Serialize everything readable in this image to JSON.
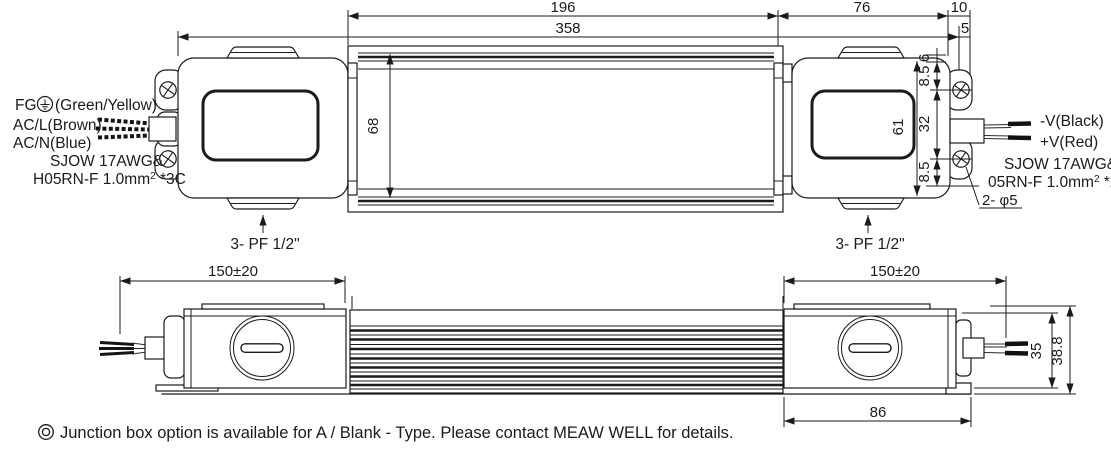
{
  "colors": {
    "ink": "#1b1b1b",
    "paper": "#ffffff"
  },
  "top_view": {
    "dims": {
      "fin_length": "196",
      "overall_length": "358",
      "box_length": "76",
      "bracket_ext": "10",
      "bracket_ext_small": "5",
      "body_width": "68",
      "box_width": "61",
      "hole_pitch": "32",
      "hole_edge_upper": "8.5",
      "edge_small": "6",
      "hole_edge_lower": "8.5"
    },
    "mounting_hole_note": "2- φ5",
    "conduit_note_left": "3- PF 1/2\"",
    "conduit_note_right": "3- PF 1/2\"",
    "input": {
      "fg": "FG",
      "fg_colors": "(Green/Yellow)",
      "line": "AC/L(Brown)",
      "neutral": "AC/N(Blue)",
      "cable1": "SJOW 17AWG&",
      "cable2": "H05RN-F 1.0mm",
      "cable2_sup": "2",
      "cable2_tail": " *3C"
    },
    "output": {
      "v_neg": "-V(Black)",
      "v_pos": "+V(Red)",
      "cable1": "SJOW 17AWG&",
      "cable2": "05RN-F 1.0mm",
      "cable2_sup": "2",
      "cable2_tail": " *2C"
    }
  },
  "side_view": {
    "dims": {
      "lead_left": "150±20",
      "lead_right": "150±20",
      "box_height": "35",
      "overall_height": "38.8",
      "box_base": "86"
    }
  },
  "footnote": {
    "bullet_icon": "bullseye-icon",
    "text": "Junction box option is available for A / Blank - Type. Please contact MEAW WELL for details."
  }
}
